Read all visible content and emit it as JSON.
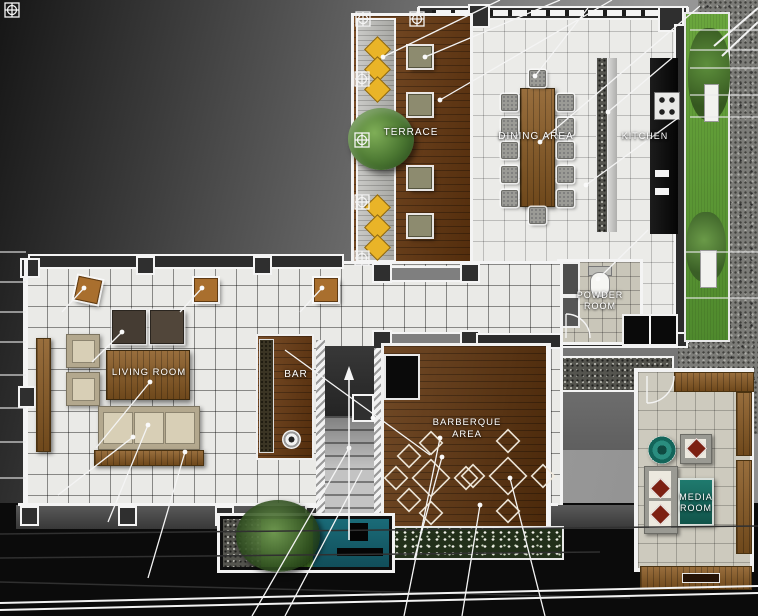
{
  "title": "Residential floor plan rendering",
  "rooms": {
    "terrace": {
      "label": "TERRACE"
    },
    "dining": {
      "label": "DINING AREA"
    },
    "kitchen": {
      "label": "KITCHEN"
    },
    "powder": {
      "label": "POWDER ROOM"
    },
    "living": {
      "label": "LIVING ROOM"
    },
    "bar": {
      "label": "BAR"
    },
    "barbeque": {
      "label": "BARBERQUE AREA"
    },
    "media": {
      "label": "MEDIA ROOM"
    }
  },
  "symbols": {
    "survey_target": "crosshair-in-square column marker",
    "stair_direction_arrow": "up"
  },
  "colors": {
    "deck_wood": "#6b3a10",
    "dining_table_wood": "#8a5a1e",
    "cabinet_wood": "#8a5a22",
    "tile": "#ebebe8",
    "grass": "#5d9a35",
    "gravel": "#7c7c78",
    "pool_teal": "#135d68",
    "media_teal": "#1a6f63",
    "pillow_red": "#7c2012",
    "flower_yellow": "#e9b428",
    "counter_black": "#101010",
    "annotation_white": "#f4f4f4"
  }
}
